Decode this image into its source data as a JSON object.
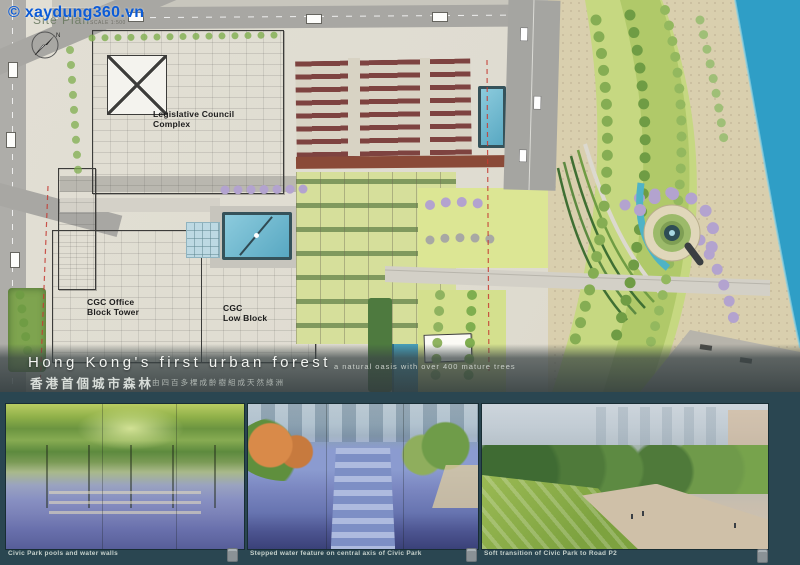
{
  "board": {
    "background_teal": "#2a4651",
    "harbor_blue": "#2f9ec6",
    "lawn_green": "#c6d881",
    "purple_tree": "#b3a3cf"
  },
  "watermark": {
    "text": "© xaydung360.vn",
    "color": "#0b5bd7"
  },
  "site_plan": {
    "label": "Site Plan",
    "scale_note": "SCALE 1:500",
    "buildings": {
      "legco_line1": "Legislative Council",
      "legco_line2": "Complex",
      "cgc_tower_line1": "CGC Office",
      "cgc_tower_line2": "Block Tower",
      "cgc_low_line1": "CGC",
      "cgc_low_line2": "Low Block"
    }
  },
  "title_block": {
    "title_en": "Hong Kong's first urban forest",
    "subtitle_en": "a natural oasis with over 400 mature trees",
    "title_zh": "香港首個城市森林",
    "subtitle_zh": "由四百多棵成齡樹組成天然綠洲"
  },
  "panels": [
    {
      "caption": "Civic Park pools and water walls"
    },
    {
      "caption": "Stepped water feature on central axis of Civic Park"
    },
    {
      "caption": "Soft transition of Civic Park to Road P2"
    }
  ]
}
